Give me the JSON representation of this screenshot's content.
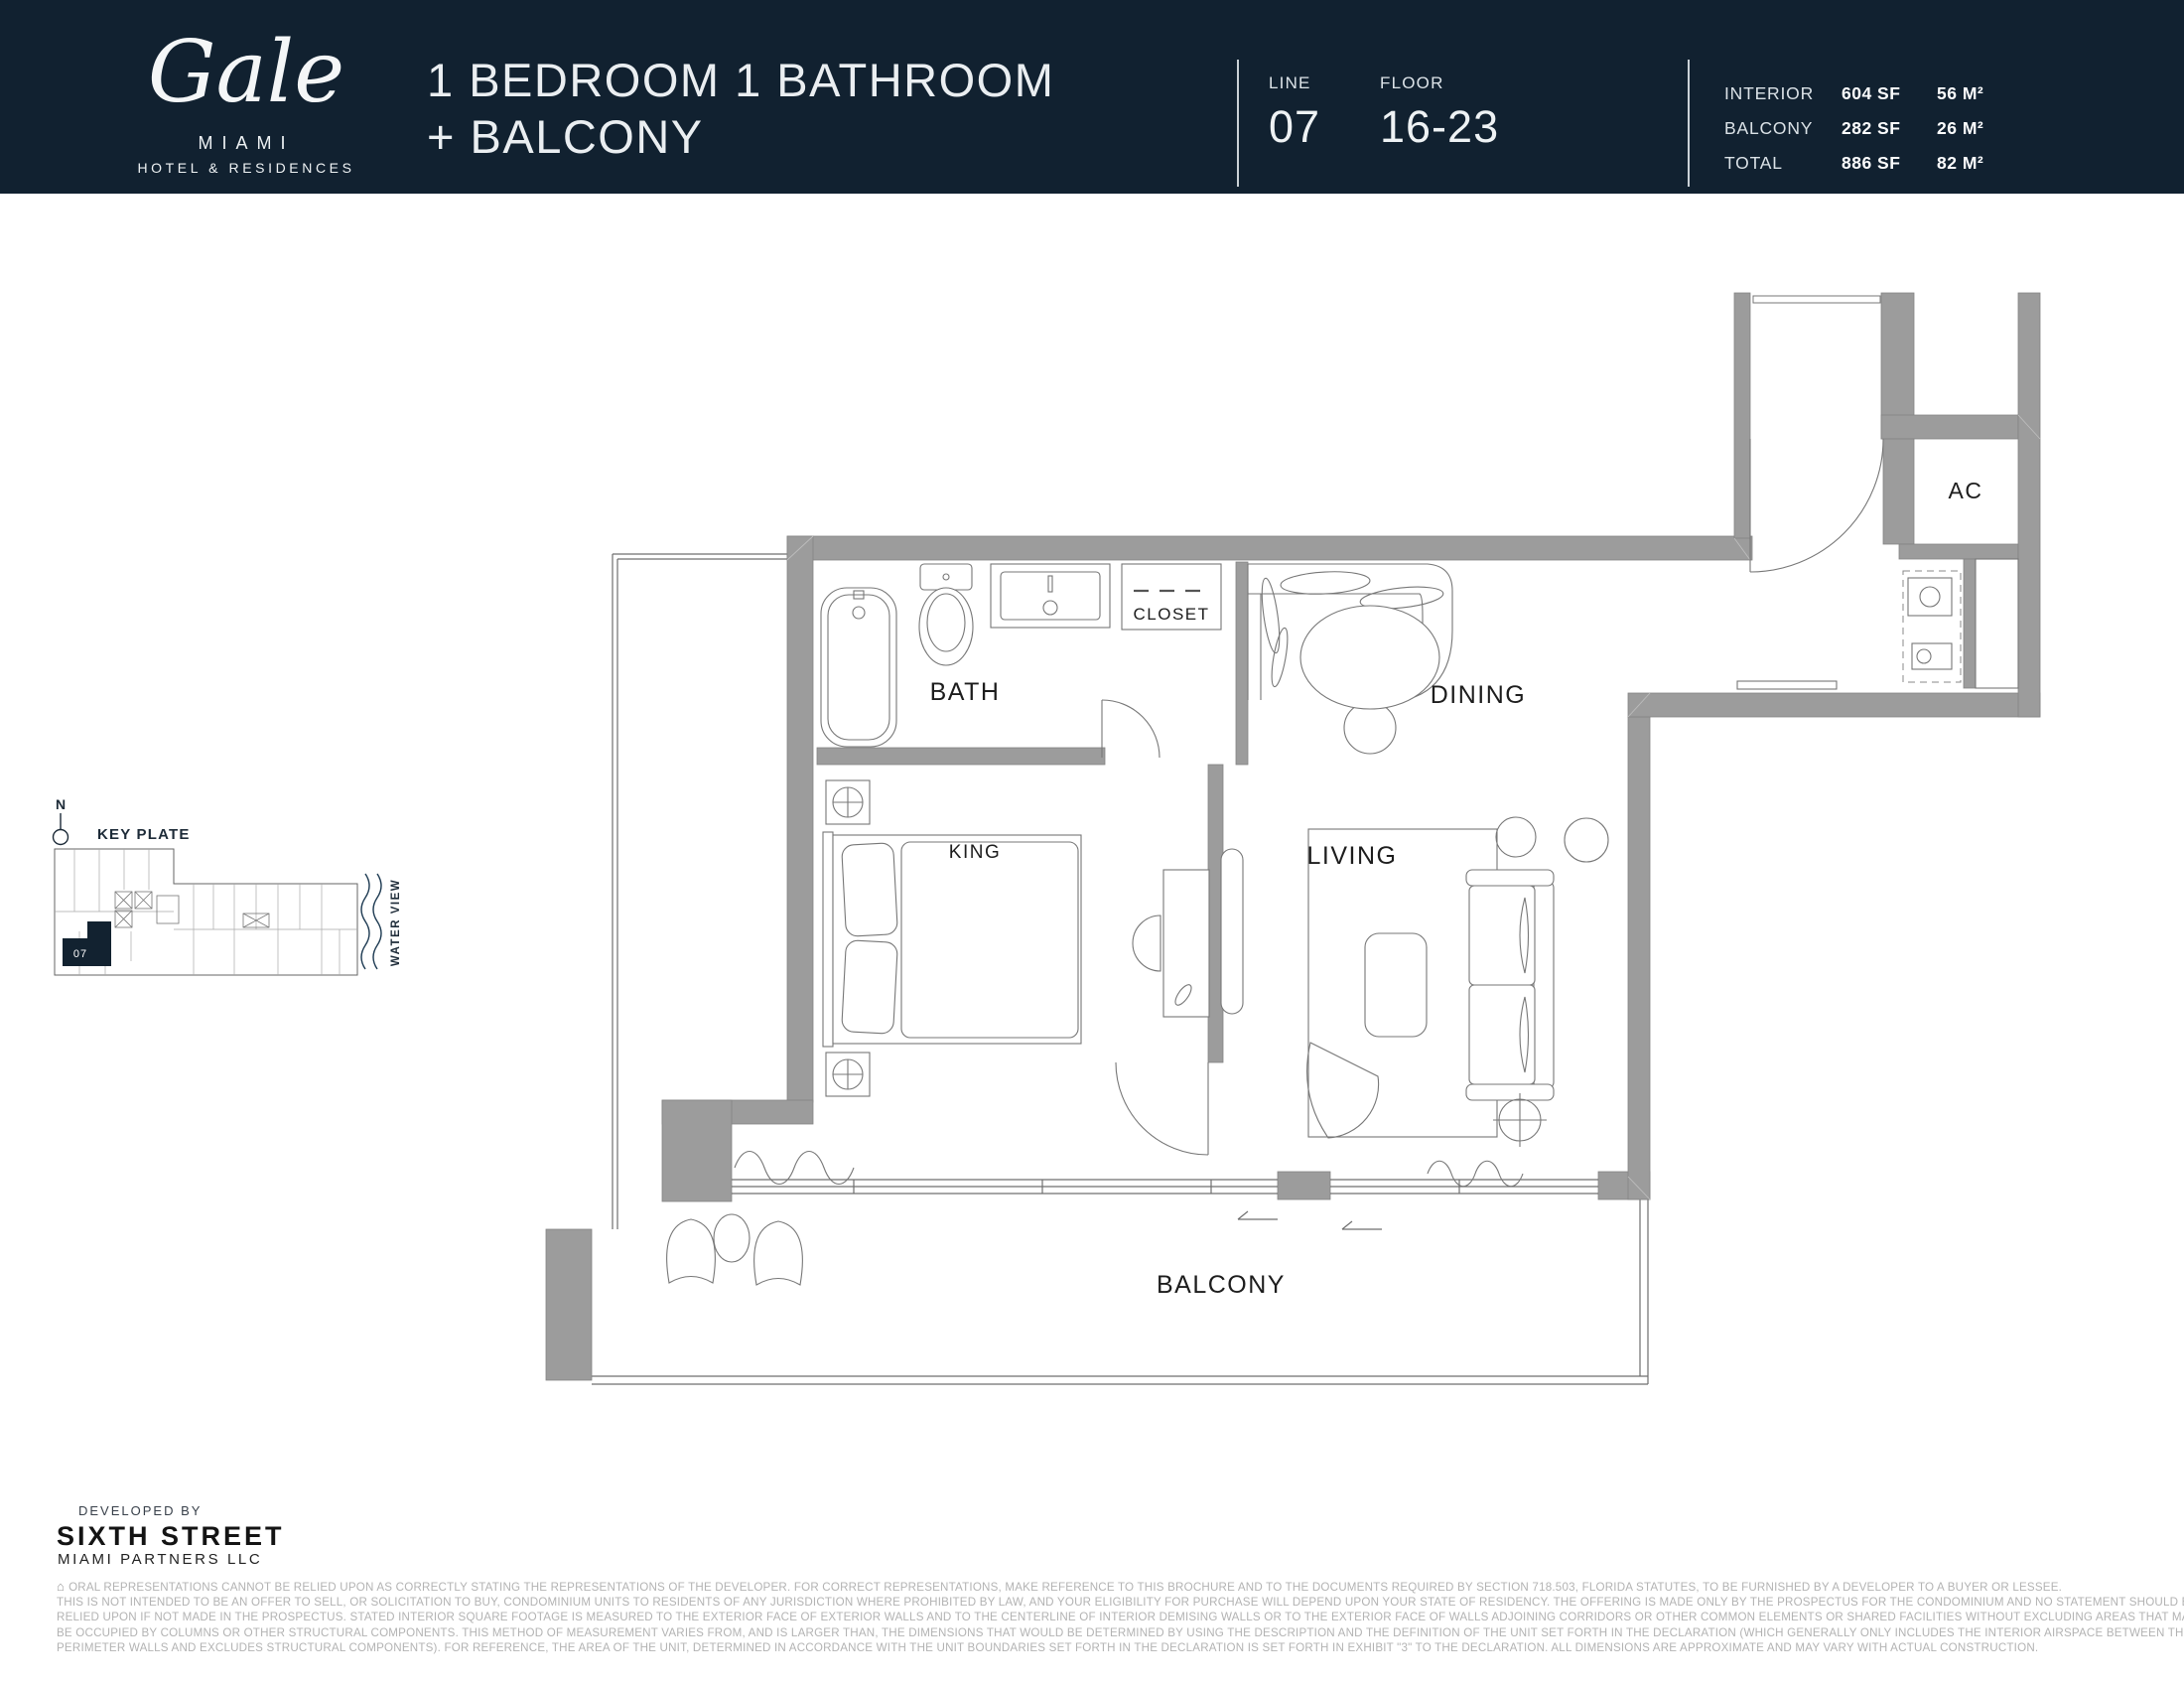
{
  "header": {
    "logo": {
      "brand": "Gale",
      "city": "MIAMI",
      "sub": "HOTEL & RESIDENCES"
    },
    "title_line1": "1 BEDROOM 1 BATHROOM",
    "title_line2": "+ BALCONY",
    "line_label": "LINE",
    "line_value": "07",
    "floor_label": "FLOOR",
    "floor_value": "16-23",
    "stats": [
      {
        "label": "INTERIOR",
        "sf": "604 SF",
        "m2": "56 M²"
      },
      {
        "label": "BALCONY",
        "sf": "282 SF",
        "m2": "26 M²"
      },
      {
        "label": "TOTAL",
        "sf": "886 SF",
        "m2": "82 M²"
      }
    ]
  },
  "key_plate": {
    "north": "N",
    "title": "KEY PLATE",
    "unit": "07",
    "water_view": "WATER VIEW"
  },
  "floor_plan": {
    "labels": {
      "bath": "BATH",
      "closet": "CLOSET",
      "dining": "DINING",
      "living": "LIVING",
      "king": "KING",
      "ac": "AC",
      "balcony": "BALCONY"
    }
  },
  "footer": {
    "developed_by": "DEVELOPED BY",
    "developer": "SIXTH STREET",
    "developer_sub": "MIAMI PARTNERS LLC",
    "equal_housing_icon": "⌂",
    "disclaimer_lines": [
      "ORAL REPRESENTATIONS CANNOT BE RELIED UPON AS CORRECTLY STATING THE REPRESENTATIONS OF THE DEVELOPER. FOR CORRECT REPRESENTATIONS, MAKE REFERENCE TO THIS BROCHURE AND TO THE DOCUMENTS REQUIRED BY SECTION 718.503, FLORIDA STATUTES, TO BE FURNISHED BY A DEVELOPER TO A  BUYER OR LESSEE.",
      "THIS IS NOT INTENDED TO BE AN OFFER TO SELL, OR SOLICITATION TO BUY, CONDOMINIUM UNITS TO RESIDENTS OF ANY JURISDICTION WHERE PROHIBITED BY LAW, AND YOUR ELIGIBILITY FOR PURCHASE WILL DEPEND UPON YOUR STATE OF RESIDENCY. THE OFFERING IS MADE ONLY BY THE PROSPECTUS FOR THE CONDOMINIUM AND NO STATEMENT SHOULD BE",
      "RELIED UPON IF NOT MADE IN THE PROSPECTUS. STATED INTERIOR SQUARE FOOTAGE IS MEASURED TO THE EXTERIOR FACE OF EXTERIOR WALLS AND TO THE CENTERLINE OF INTERIOR DEMISING WALLS OR TO THE EXTERIOR FACE OF WALLS ADJOINING CORRIDORS OR OTHER COMMON ELEMENTS OR SHARED FACILITIES WITHOUT EXCLUDING AREAS THAT MAY",
      "BE OCCUPIED BY COLUMNS OR OTHER STRUCTURAL COMPONENTS. THIS METHOD OF MEASUREMENT VARIES FROM, AND IS LARGER THAN, THE DIMENSIONS THAT WOULD BE DETERMINED BY USING THE DESCRIPTION AND THE DEFINITION OF THE UNIT SET FORTH IN THE DECLARATION (WHICH GENERALLY ONLY INCLUDES THE INTERIOR AIRSPACE BETWEEN THE",
      "PERIMETER WALLS AND EXCLUDES STRUCTURAL COMPONENTS). FOR REFERENCE, THE AREA OF THE UNIT, DETERMINED IN ACCORDANCE WITH THE UNIT BOUNDARIES SET FORTH IN THE DECLARATION IS SET FORTH IN EXHIBIT \"3\" TO THE DECLARATION. ALL DIMENSIONS ARE APPROXIMATE AND MAY VARY WITH ACTUAL CONSTRUCTION."
    ]
  },
  "colors": {
    "navy": "#112130",
    "wall_gray": "#9c9c9c",
    "line_gray": "#6f6f6f"
  }
}
